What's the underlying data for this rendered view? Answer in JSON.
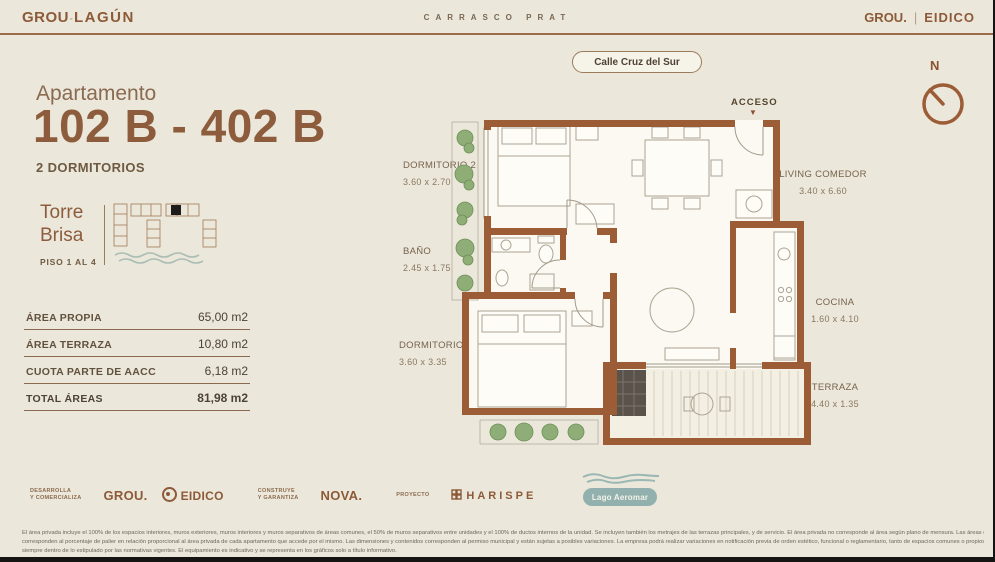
{
  "header": {
    "brand_left_primary": "GROU",
    "brand_left_sep": "◦",
    "brand_left_secondary": "LAGÚN",
    "project_name": "CARRASCO PRAT",
    "brand_right_primary": "GROU.",
    "brand_right_secondary": "EIDICO"
  },
  "sidebar": {
    "subtitle": "Apartamento",
    "title": "102 B - 402 B",
    "bedrooms": "2 DORMITORIOS",
    "tower_name": "Torre\nBrisa",
    "tower_floors": "PISO 1 AL 4",
    "area_rows": [
      {
        "label": "ÁREA PROPIA",
        "value": "65,00 m2"
      },
      {
        "label": "ÁREA TERRAZA",
        "value": "10,80 m2"
      },
      {
        "label": "CUOTA PARTE DE AACC",
        "value": "6,18 m2"
      },
      {
        "label": "TOTAL ÁREAS",
        "value": "81,98 m2"
      }
    ]
  },
  "plan": {
    "street_badge": "Calle Cruz del Sur",
    "access_label": "ACCESO",
    "access_arrow": "▼",
    "compass_label": "N",
    "rooms": [
      {
        "name": "DORMITORIO 2",
        "dims": "3.60 x 2.70"
      },
      {
        "name": "BAÑO",
        "dims": "2.45 x 1.75"
      },
      {
        "name": "DORMITORIO 1",
        "dims": "3.60 x 3.35"
      },
      {
        "name": "LIVING COMEDOR",
        "dims": "3.40 x 6.60"
      },
      {
        "name": "COCINA",
        "dims": "1.60 x 4.10"
      },
      {
        "name": "TERRAZA",
        "dims": "4.40 x 1.35"
      }
    ],
    "lake_badge": "Lago Aeromar"
  },
  "footer": {
    "dev_role": "Desarrolla\ny comercializa",
    "dev_brand1": "GROU.",
    "dev_brand2": "EIDICO",
    "build_role": "Construye\ny garantiza",
    "build_brand": "NOVA.",
    "project_role": "Proyecto",
    "project_brand": "HARISPE",
    "legal": [
      "El área privada incluye el 100% de los espacios interiores, muros exteriores, muros interiores y muros separativos de áreas comunes, el 50% de muros separativos entre unidades y el 100% de ductos internos de la unidad. Se incluyen también los metrajes de las terrazas principales, y de servicio. El área privada no corresponde al área según plano de mensura. Las áreas comunes",
      "corresponden al porcentaje de palier en relación proporcional al área privada de cada apartamento que accede por el mismo. Las dimensiones y contenidos corresponden al permiso municipal y están sujetas a posibles variaciones. La empresa podrá realizar variaciones en notificación previa de orden estético, funcional o reglamentario, tanto de espacios comunes o propios,",
      "siempre dentro de lo estipulado por las normativas vigentes. El equipamiento es indicativo y se representa en los gráficos solo a título informativo."
    ]
  },
  "colors": {
    "background": "#ebe7da",
    "accent_brown": "#8c5a38",
    "wall_brown": "#9c5c36",
    "teal": "#92b1ae",
    "plant_green": "#8fae77"
  }
}
